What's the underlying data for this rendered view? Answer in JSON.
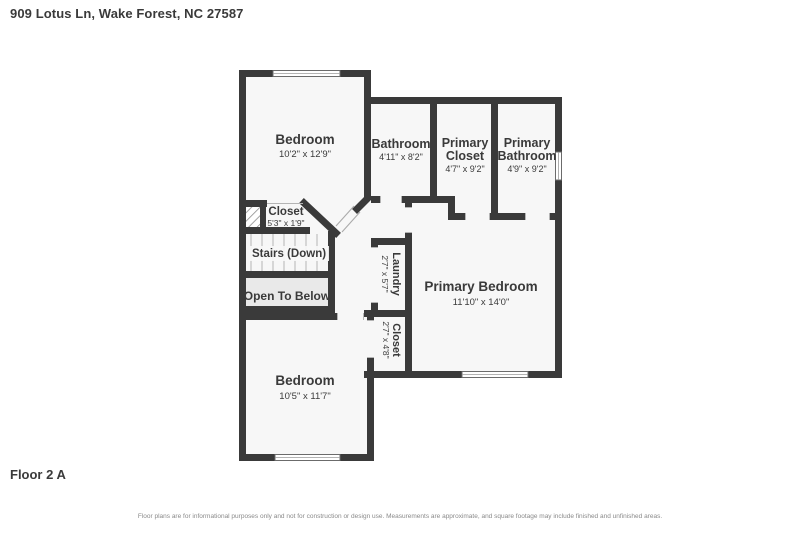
{
  "header": {
    "address": "909 Lotus Ln, Wake Forest, NC 27587"
  },
  "footer": {
    "floor_label": "Floor 2 A",
    "disclaimer": "Floor plans are for informational purposes only and not for construction or design use. Measurements are approximate, and square footage may include finished and unfinished areas."
  },
  "colors": {
    "wall": "#3a3a3a",
    "room": "#f7f7f7",
    "open": "#e9e9e9",
    "text": "#3a3a3a",
    "muted": "#8a8a8a"
  },
  "rooms": [
    {
      "id": "bedroom-upper",
      "name": "Bedroom",
      "dims": "10'2\" x 12'9\""
    },
    {
      "id": "bathroom",
      "name": "Bathroom",
      "dims": "4'11\" x 8'2\""
    },
    {
      "id": "primary-closet",
      "name": "Primary Closet",
      "lines": [
        "Primary",
        "Closet"
      ],
      "dims": "4'7\" x 9'2\""
    },
    {
      "id": "primary-bathroom",
      "name": "Primary Bathroom",
      "lines": [
        "Primary",
        "Bathroom"
      ],
      "dims": "4'9\" x 9'2\""
    },
    {
      "id": "hall-closet",
      "name": "Closet",
      "dims": "5'3\" x 1'9\""
    },
    {
      "id": "stairs",
      "name": "Stairs (Down)"
    },
    {
      "id": "open-to-below",
      "name": "Open To Below"
    },
    {
      "id": "laundry",
      "name": "Laundry",
      "dims": "2'7\" x 5'7\""
    },
    {
      "id": "bedroom-closet",
      "name": "Closet",
      "dims": "2'7\" x 4'8\""
    },
    {
      "id": "primary-bedroom",
      "name": "Primary Bedroom",
      "dims": "11'10\" x 14'0\""
    },
    {
      "id": "bedroom-lower",
      "name": "Bedroom",
      "dims": "10'5\" x 11'7\""
    }
  ]
}
